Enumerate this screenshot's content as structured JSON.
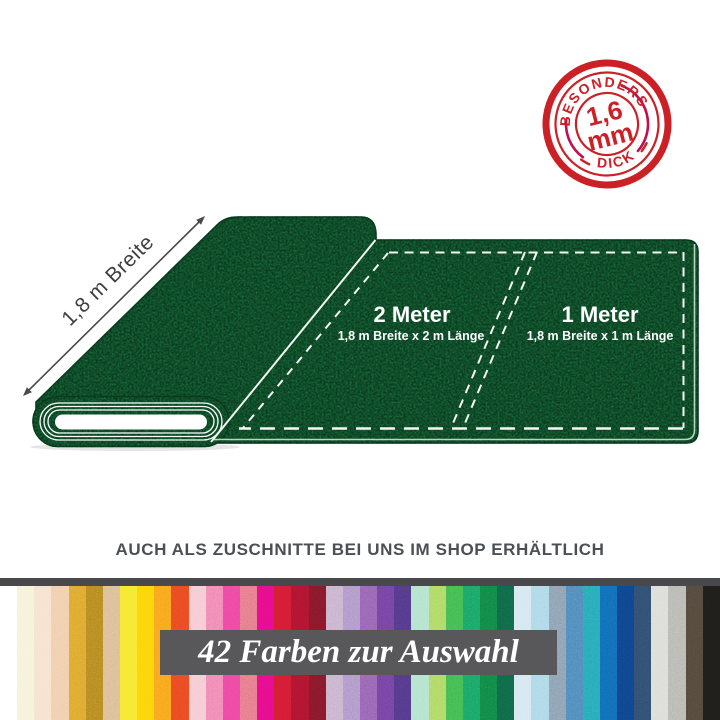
{
  "badge": {
    "top_text": "BESONDERS",
    "value": "1,6",
    "unit": "mm",
    "bottom_text": "DICK"
  },
  "diagram": {
    "width_label": "1,8 m Breite",
    "sections": [
      {
        "title": "2 Meter",
        "subtitle": "1,8 m Breite x 2 m Länge"
      },
      {
        "title": "1 Meter",
        "subtitle": "1,8 m Breite x 1 m Länge"
      }
    ]
  },
  "tagline": "AUCH ALS ZUSCHNITTE BEI UNS IM SHOP ERHÄLTLICH",
  "color_strip": {
    "banner_text": "42 Farben zur Auswahl",
    "colors": [
      "#ffffff",
      "#f5f1d6",
      "#f5dfc9",
      "#efc8a4",
      "#d99e2b",
      "#ae7c20",
      "#d8b68c",
      "#f6e62e",
      "#fccf09",
      "#f89b1b",
      "#e8431f",
      "#f6c4ce",
      "#ef7cab",
      "#eb4295",
      "#e3707d",
      "#e30c7e",
      "#cd1a2e",
      "#a5132a",
      "#7a1626",
      "#c3aac7",
      "#a78bc3",
      "#8a5cab",
      "#6a3d96",
      "#4c347c",
      "#a9e0c6",
      "#a6d45c",
      "#3eb24b",
      "#1a9a5e",
      "#107a40",
      "#0e5e41",
      "#d0e4ef",
      "#a3d4e4",
      "#8095aa",
      "#4a7db5",
      "#259fae",
      "#1063ae",
      "#0d3e7e",
      "#2c4766",
      "#d8d8d4",
      "#b1b1ab",
      "#4c4237",
      "#1d1b19"
    ]
  },
  "colors": {
    "felt_green": "#186c3b",
    "stamp_red": "#cb2026",
    "stamp_accent": "#c0104d",
    "banner_bg": "#58585a",
    "strip_bar": "#49494b",
    "tagline_text": "#4b5055"
  }
}
